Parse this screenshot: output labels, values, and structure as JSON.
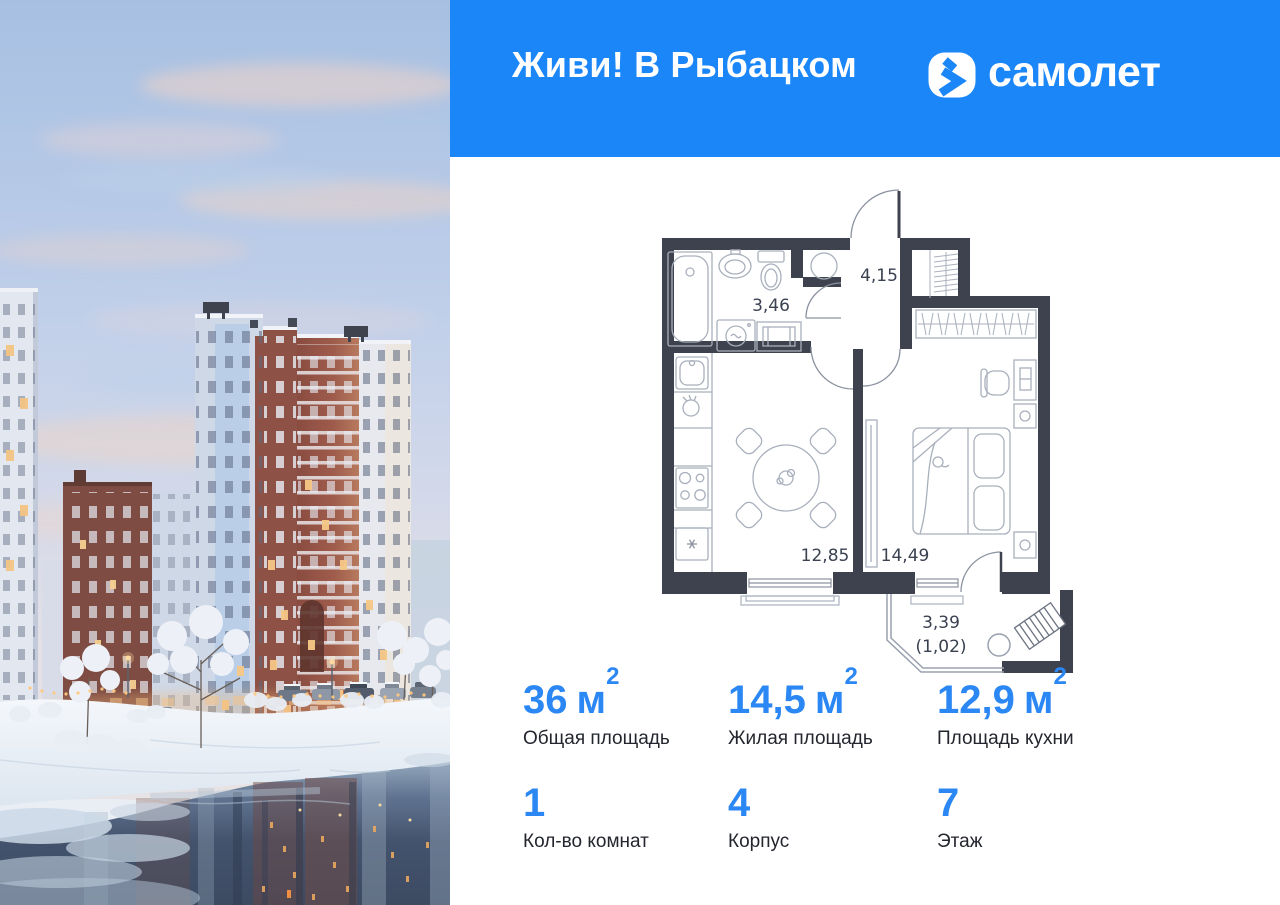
{
  "header": {
    "title": "Живи! В Рыбацком",
    "brand": "самолет"
  },
  "colors": {
    "header_bg": "#1a86f8",
    "accent_blue": "#2b87f3",
    "plan_wall": "#3d424e",
    "plan_thin_line": "#a9b0bc",
    "label_text": "#23262e"
  },
  "plan": {
    "rooms": [
      {
        "name": "bathroom",
        "area": "3,46"
      },
      {
        "name": "hallway",
        "area": "4,15"
      },
      {
        "name": "kitchen",
        "area": "12,85"
      },
      {
        "name": "bedroom",
        "area": "14,49"
      },
      {
        "name": "balcony",
        "area": "3,39"
      },
      {
        "name": "balcony-reduced",
        "area": "(1,02)"
      }
    ]
  },
  "stats": {
    "row1": [
      {
        "value": "36",
        "unit_base": "м",
        "unit_sup": "2",
        "label": "Общая площадь"
      },
      {
        "value": "14,5",
        "unit_base": "м",
        "unit_sup": "2",
        "label": "Жилая площадь"
      },
      {
        "value": "12,9",
        "unit_base": "м",
        "unit_sup": "2",
        "label": "Площадь кухни"
      }
    ],
    "row2": [
      {
        "value": "1",
        "unit_base": "",
        "unit_sup": "",
        "label": "Кол-во комнат"
      },
      {
        "value": "4",
        "unit_base": "",
        "unit_sup": "",
        "label": "Корпус"
      },
      {
        "value": "7",
        "unit_base": "",
        "unit_sup": "",
        "label": "Этаж"
      }
    ]
  }
}
